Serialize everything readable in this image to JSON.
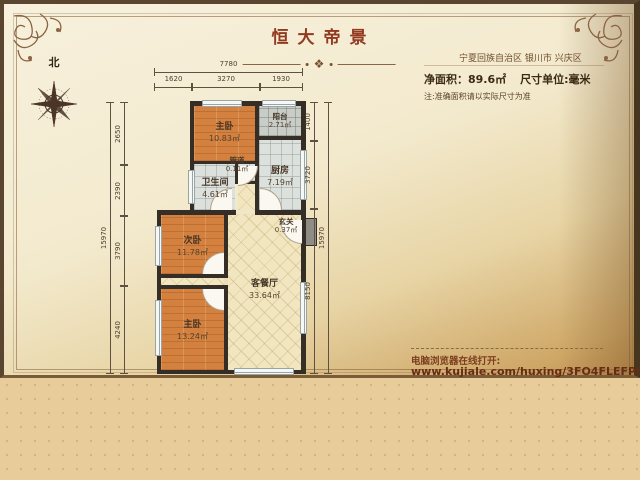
{
  "header": {
    "title": "恒大帝景",
    "location": "宁夏回族自治区 银川市 兴庆区",
    "area_label": "净面积：",
    "area_value": "89.6㎡",
    "unit_label": "尺寸单位:毫米",
    "note": "注:准确面积请以实际尺寸为准"
  },
  "compass": {
    "north_label": "北"
  },
  "rooms": [
    {
      "name": "主卧",
      "area": "10.83㎡"
    },
    {
      "name": "阳台",
      "area": "2.71㎡"
    },
    {
      "name": "管道",
      "area": "0.11㎡"
    },
    {
      "name": "卫生间",
      "area": "4.61㎡"
    },
    {
      "name": "厨房",
      "area": "7.19㎡"
    },
    {
      "name": "玄关",
      "area": "0.37㎡"
    },
    {
      "name": "次卧",
      "area": "11.78㎡"
    },
    {
      "name": "客餐厅",
      "area": "33.64㎡"
    },
    {
      "name": "主卧",
      "area": "13.24㎡"
    }
  ],
  "dimensions": {
    "unit": "毫米",
    "top_total": "7780",
    "top_segments": [
      "1620",
      "3270",
      "1930"
    ],
    "left_total": "15970",
    "left_segments": [
      "2650",
      "2390",
      "3790",
      "4240"
    ],
    "right_total": "15970",
    "right_segments": [
      "1400",
      "3720",
      "8150"
    ]
  },
  "footer": {
    "open_hint": "电脑浏览器在线打开:",
    "url": "www.kujiale.com/huxing/3FO4FLEFPUKK"
  },
  "colors": {
    "title": "#923a20",
    "url_text": "#672c14",
    "wall": "#342e27",
    "bedroom_floor": "#d4813f",
    "tile_floor": "#dde1dd",
    "living_floor": "#f2e6c0",
    "balcony_floor": "#c9cdc7",
    "entry_floor": "#8f8b85",
    "page_top": "#f7f0dc",
    "page_bottom": "#c09050",
    "canvas_bottom": "#e8cc9a"
  }
}
